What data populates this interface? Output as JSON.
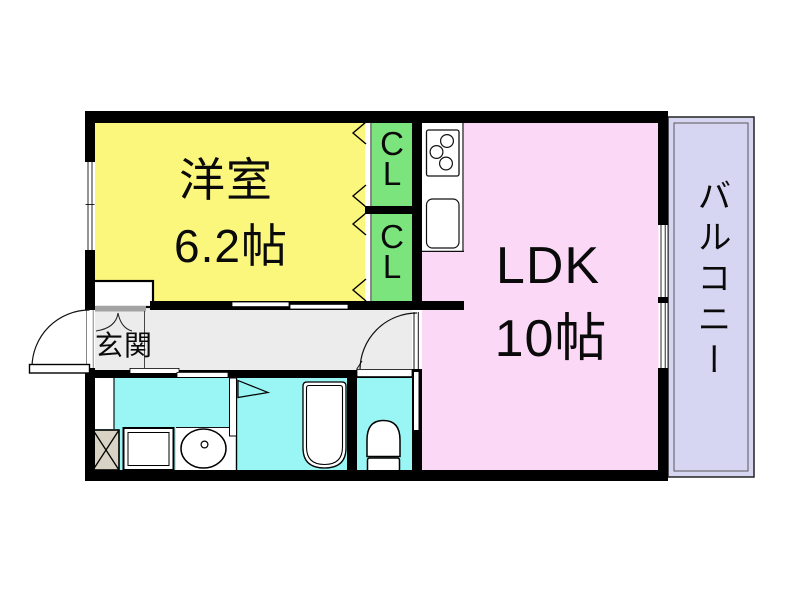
{
  "plan": {
    "western_room": {
      "name": "洋室",
      "area": "6.2帖"
    },
    "ldk": {
      "name": "LDK",
      "area": "10帖"
    },
    "entrance": {
      "name": "玄関"
    },
    "balcony": {
      "name": "バルコニー"
    },
    "closet_upper": {
      "char1": "C",
      "char2": "L"
    },
    "closet_lower": {
      "char1": "C",
      "char2": "L"
    }
  },
  "fixtures": [
    "kitchen-stove",
    "kitchen-sink",
    "bathtub",
    "toilet",
    "washbasin",
    "washing-machine",
    "laundry-pan",
    "entrance-door",
    "ldk-door",
    "bath-folding-door",
    "closet-sliding-doors",
    "window",
    "balcony-rail"
  ],
  "colors": {
    "wall": "#000000",
    "western_room_fill": "#FBF77D",
    "closet_fill": "#7CE47C",
    "ldk_fill": "#FBD9F6",
    "balcony_fill": "#D6D6F2",
    "wet_area_fill": "#9AF5F5",
    "hallway_fill": "#ECECEC",
    "entrance_step": "#A3A3A3",
    "laundry_pan_fill": "#D8D3C4"
  }
}
